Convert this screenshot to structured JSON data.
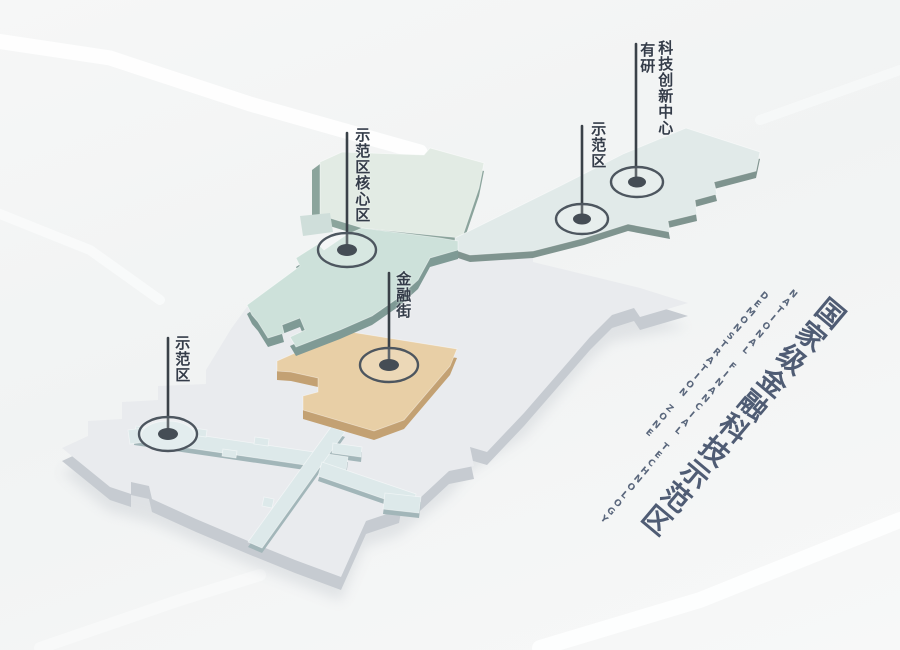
{
  "watermark": {
    "cn": "国家级金融科技示范区",
    "en_line1": "NATIONAL FINANCIAL TECHNOLOGY",
    "en_line2": "DEMONSTRATION ZONE"
  },
  "pins": {
    "innovation_center": {
      "prefix": "有研",
      "label": "科技创新中心"
    },
    "demo_zone_ne": {
      "label": "示范区"
    },
    "core_area": {
      "label": "示范区核心区"
    },
    "finance_street": {
      "label": "金融街"
    },
    "demo_zone_sw": {
      "label": "示范区"
    }
  },
  "colors": {
    "base_fill": "#e9ebee",
    "base_side": "#c6cbd1",
    "core_area_fill": "#cde1da",
    "core_area_side": "#7f9a95",
    "upper_plate_fill": "#e2ebe4",
    "innovation_band_fill": "#e1eae9",
    "innovation_band_side": "#7f948f",
    "finance_street_fill": "#e8cfa6",
    "finance_street_side": "#c3a173",
    "street_fill": "#dde9ea",
    "street_side": "#a2b6b9",
    "label_text": "#343c49",
    "watermark_text": "#42506a"
  }
}
